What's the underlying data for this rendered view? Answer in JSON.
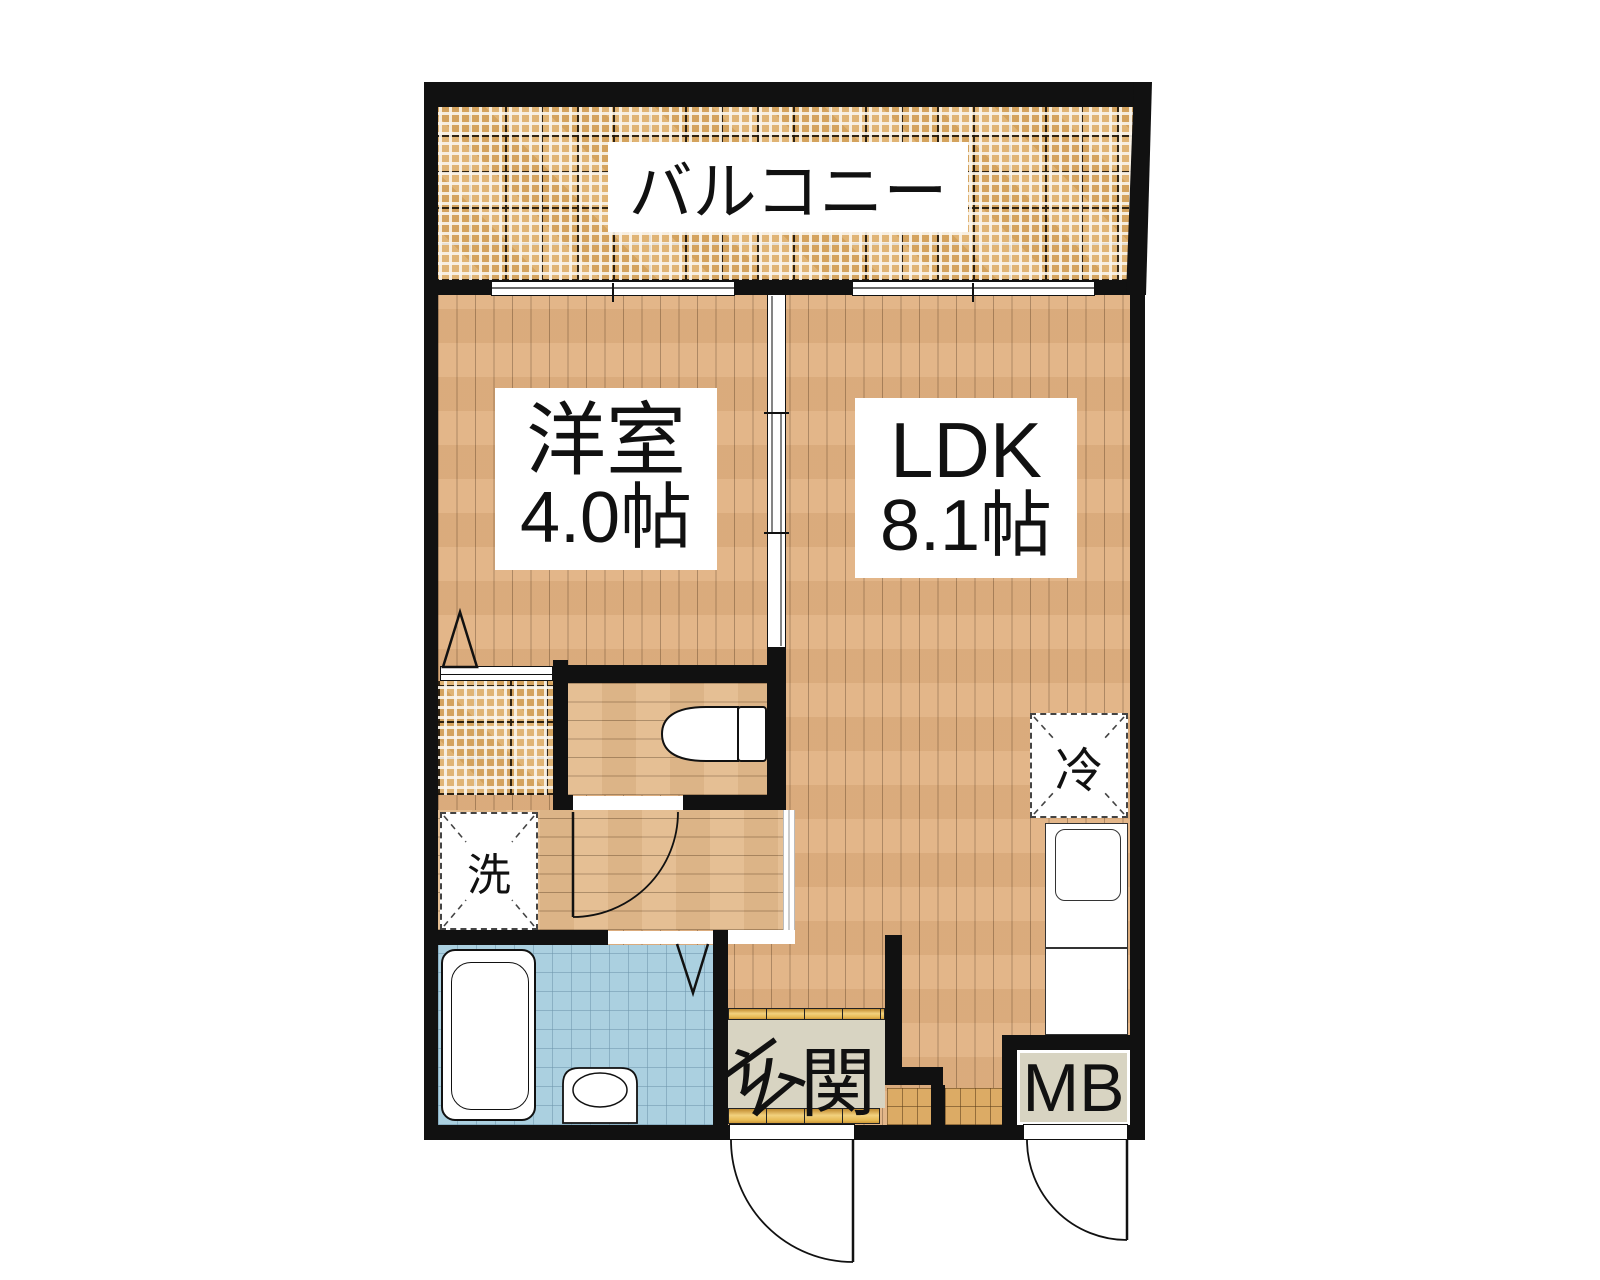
{
  "plan": {
    "type": "floor-plan",
    "rooms": {
      "balcony": {
        "label": "バルコニー"
      },
      "western_room": {
        "label": "洋室",
        "size": "4.0帖"
      },
      "ldk": {
        "label": "LDK",
        "size": "8.1帖"
      },
      "entrance": {
        "label_char1": "玄",
        "label_char2": "関"
      },
      "meter_box": {
        "label": "MB"
      },
      "refrigerator": {
        "label": "冷"
      },
      "washer": {
        "label": "洗"
      }
    }
  },
  "theme": {
    "wall": "#111111",
    "ink": "#111111",
    "wood": "#e2b283",
    "wood2": "#e4bc8e",
    "tile": "#dcab65",
    "bath": "#abd0e0",
    "beige": "#d8d4c2",
    "white": "#ffffff"
  }
}
